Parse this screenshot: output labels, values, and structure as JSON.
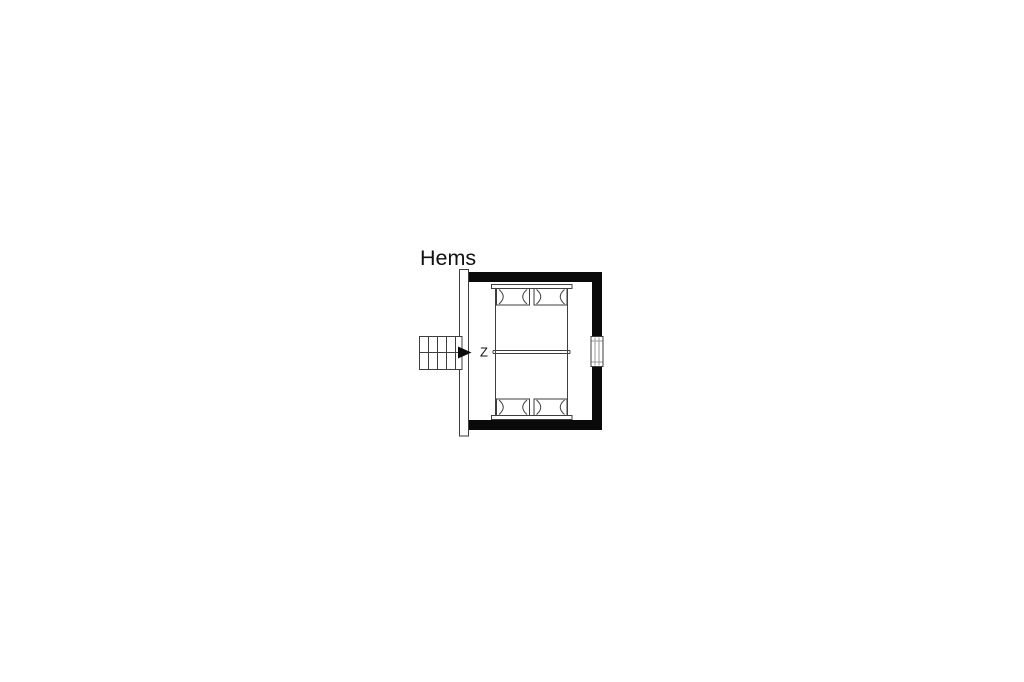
{
  "plan": {
    "title": "Hems",
    "stair_label": "Z",
    "colors": {
      "wall": "#0a0a0a",
      "line": "#3e3e3e",
      "window_line": "#9a9a9a",
      "background": "#ffffff"
    }
  }
}
